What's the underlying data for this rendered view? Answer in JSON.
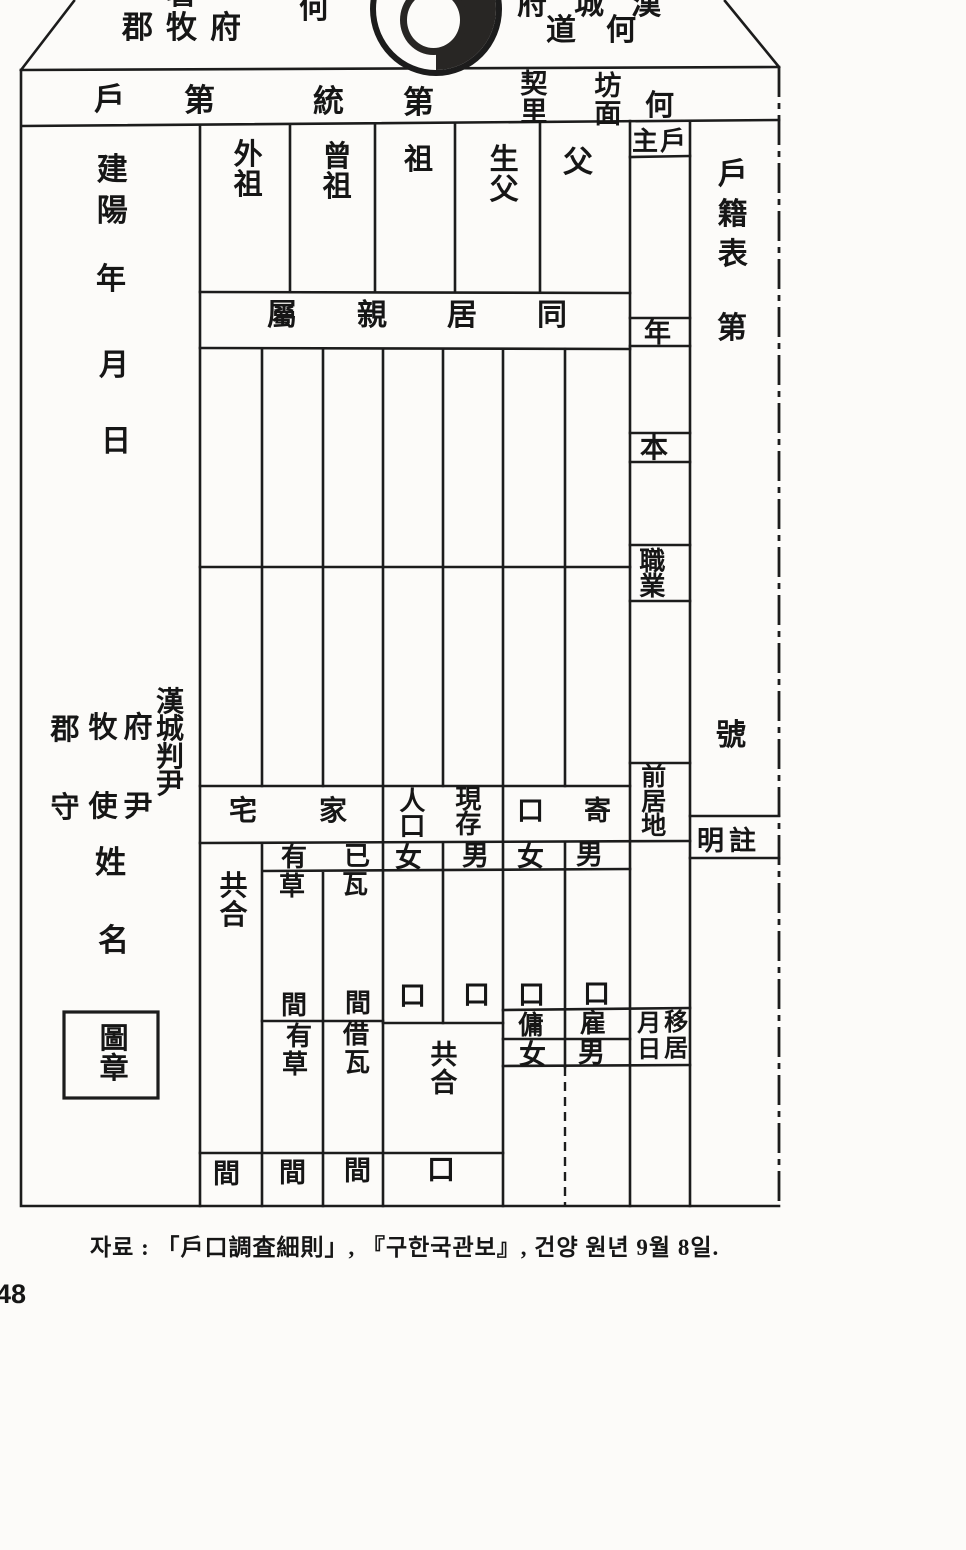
{
  "page": {
    "number": "48",
    "caption": "자료 : 「戶口調査細則」, 『구한국관보』, 건양 원년 9월 8일."
  },
  "flap": {
    "seo": "署",
    "gunmokbu": "郡牧府",
    "ha": "何",
    "hanseongbu": "府城漢",
    "hado": "道何",
    "emblem": "taegeuk-emblem"
  },
  "band": {
    "ho": "戶",
    "je1": "第",
    "tong": "統",
    "je2": "第",
    "gyeri": "契里",
    "bangmyeon": "坊面",
    "ha": "何"
  },
  "datecol": {
    "era": "建陽",
    "year": "年",
    "month": "月",
    "day": "日"
  },
  "ancestors": {
    "oejo": "外祖",
    "jeungjo": "曾祖",
    "jo": "祖",
    "saengbu": "生父",
    "bu": "父",
    "juho": "主戶",
    "cohabit": "屬親居同"
  },
  "fields": {
    "age": "年",
    "bon": "本",
    "job": "職業",
    "prev": "前居地",
    "move_r": "移居",
    "move_l": "月日"
  },
  "register": {
    "title": "戶籍表",
    "je": "第",
    "ho": "號",
    "note": "明註"
  },
  "officials": {
    "gunsu": "郡守",
    "moksa": "牧使",
    "buyun": "府尹",
    "panyun": "漢城判尹",
    "surname": "姓",
    "name": "名",
    "seal": "圖章"
  },
  "housing": {
    "header": "宅家",
    "total": "共合",
    "own_yu": "有",
    "own_i": "已",
    "own_cho": "草",
    "own_wa": "瓦",
    "kan1": "間",
    "kan2": "間",
    "rent_yu": "有",
    "rent_cha": "借",
    "rent_cho": "草",
    "rent_wa": "瓦",
    "kan_total": "間",
    "kan3": "間",
    "kan4": "間"
  },
  "population": {
    "in_gu": "人口",
    "hyeonjon": "現存",
    "gi_gu": "口寄",
    "f1": "女",
    "m1": "男",
    "f2": "女",
    "m2": "男",
    "b1": "口",
    "b2": "口",
    "b3": "口",
    "b4": "口",
    "total": "共合",
    "yong": "傭",
    "go": "雇",
    "f3": "女",
    "m3": "男",
    "total_box": "口"
  }
}
